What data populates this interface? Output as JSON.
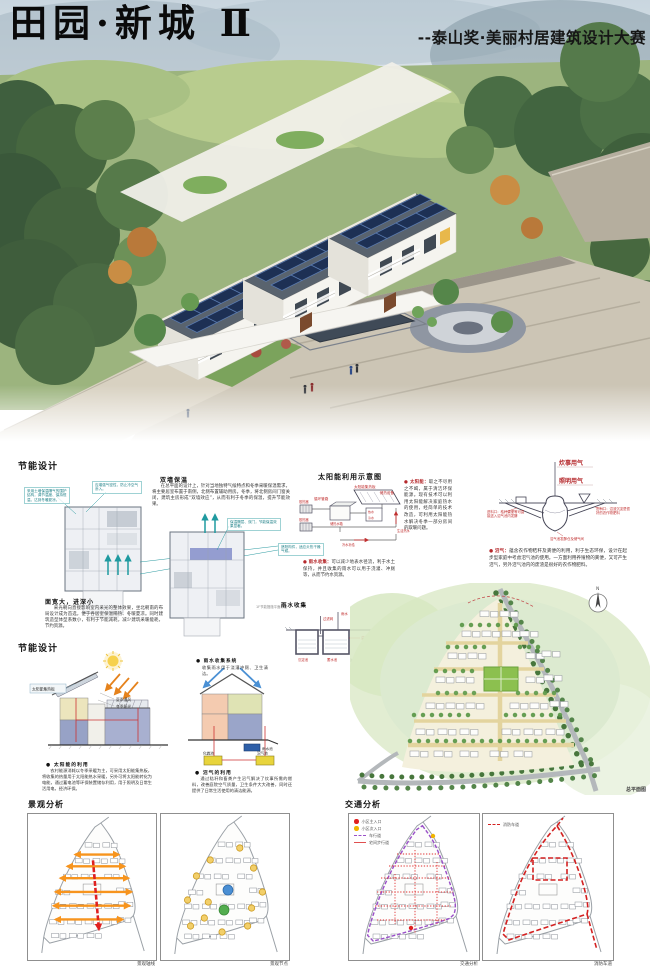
{
  "header": {
    "title": "田园·新城 Ⅱ",
    "subtitle": "--泰山奖·美丽村居建筑设计大赛"
  },
  "colors": {
    "accent_red": "#b5292c",
    "teal": "#1f9aa0",
    "orange": "#f7941d",
    "purple": "#9a50c8",
    "fire_red": "#d42020",
    "solar_panel": "#1d3054"
  },
  "energy1": {
    "title": "节能设计",
    "callout_wall": "采用土墙保温隔气的围护结构，调节温度、保持恒温，达到冬暖夏凉。",
    "callout_air": "应增强气密性，防止冷空气渗入。",
    "callout_shade": "遮阳构件，适应炎热干燥气候。",
    "callout_insul": "保温隔层、双门，节能保温效果显著。",
    "plan1_caption": "面宽大，进深小",
    "plan1_text": "采光朝向直接影响室内采光的整体效果，坐北朝南的布局设计成为首选，便于各居室保温隔热、冬暖夏凉。同时建筑造型体型系数小，有利于节能减耗，减少建筑采暖能耗，节约资源。",
    "wall_title": "双墙保温",
    "wall_text": "在总平面的设计上，针对当地独特气候特点和冬季采暖保温需求，将主要居室布置于南侧，北侧布置辅助用房。冬季，将北侧房间门窗关闭，建筑主房形成“双墙效应”，从而有利于冬季的保温，提升节能效果。",
    "plan2_note": "1F节能措施平面示意"
  },
  "solar": {
    "title": "太阳能利用示意图",
    "labels": {
      "loop": "循环管路",
      "panel": "太阳能集热板",
      "store": "储热设备",
      "rad1": "散热器",
      "rad2": "散热器",
      "tank": "储热水箱",
      "hot": "热水",
      "cold": "冷水",
      "supply": "冷水补给",
      "use": "生活热水"
    },
    "bullet_solar_term": "● 太阳能：",
    "bullet_solar_text": "取之不尽用之不竭，属于清洁环保能源。现有技术可以利用太阳能解决家庭热水的使用，经简单的技术改造，可利用太阳能热水解决冬季一部分房间的取暖问题。",
    "bullet_rain_term": "● 雨水收集：",
    "bullet_rain_text": "可以减少地表水径流，利于水土保持，并且收集的雨水可以用于浇灌、冲厕等，从而节约水资源。"
  },
  "rainwater": {
    "title": "雨水收集",
    "labels": {
      "rain": "雨水",
      "filter": "过滤网",
      "overflow": "溢流管",
      "sediment": "沉淀池",
      "storage": "蓄水池",
      "note": "注：池内壁做防水处理"
    }
  },
  "biogas": {
    "cook": "炊事用气",
    "light": "照明用气",
    "inlet": "进料口：秸秆粪便等可直接送入沼气池内发酵",
    "outlet": "出料口：沼渣沉淀是很好的农作物肥料",
    "pool": "沼气池发酵仓及储气间",
    "term": "● 沼气：",
    "text": "蕴含农作物秸秆及粪便的利用，利于生态环保，设计在起步型家庭中考虑沼气池的使用。一方面利用养殖物的粪便，又可产生沼气，另外沼气池内的废渣是很好的农作物肥料。"
  },
  "energy2": {
    "title": "节能设计",
    "panel": "太阳能集热板",
    "summer": "夏季通风",
    "winter": "冬季阳光",
    "solar_caption": "● 太阳能的利用",
    "solar_text": "农村能源消耗以冬季采暖为主，可采用太阳能集热板，将收集的热量用于太阳能热水采暖，另外可将太阳能转化为电能，通过蓄电池等环保装置储存利用，用于照明及日常生活用电，经济环保。",
    "rain_caption": "● 雨水收集系统",
    "rain_text": "收集雨水用于浇灌冲厕、卫生清洁。",
    "rainpool": "雨水池",
    "septic": "化粪池",
    "biogaspool": "沼气池",
    "biogas_caption": "● 沼气的利用",
    "biogas_text": "通过秸秆和畜粪产生沼气解决了炊事所需的燃料，改善庭院空气质量，卫生条件大大改善，同时还提供了日常生活使用的清洁能源。"
  },
  "masterplan": {
    "caption": "总平面图",
    "north": "N"
  },
  "landscape": {
    "title": "景观分析",
    "caption_axis": "景观轴线",
    "caption_node": "景观节点"
  },
  "traffic": {
    "title": "交通分析",
    "legend": [
      {
        "label": "小区主入口"
      },
      {
        "label": "小区次入口"
      },
      {
        "label": "车行道"
      },
      {
        "label": "宅间步行道"
      }
    ],
    "fire_legend": "消防车道",
    "caption_left": "交通分析",
    "caption_right": "消防车道"
  }
}
